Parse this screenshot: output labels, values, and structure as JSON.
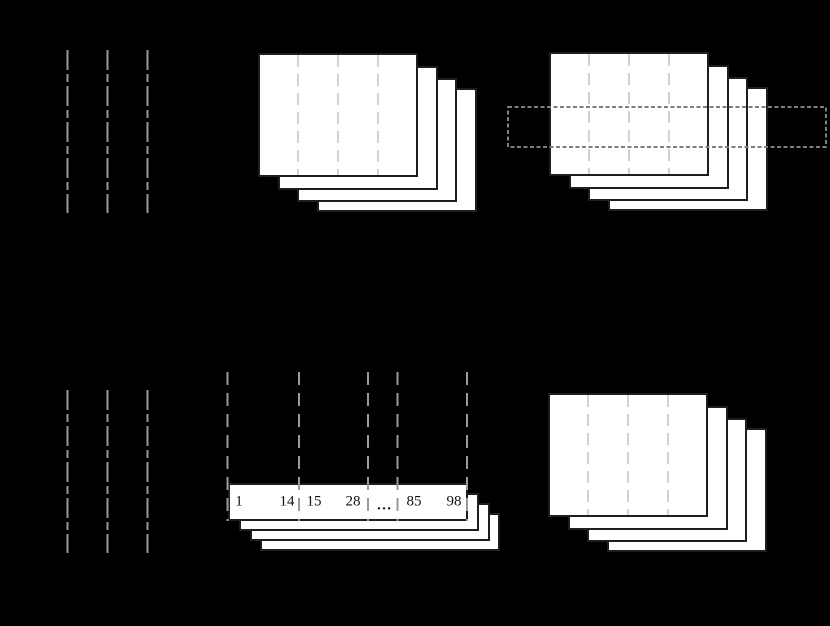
{
  "figure": {
    "background": "#000000",
    "colors": {
      "frame_fill": "#ffffff",
      "frame_border": "#1e1e1e",
      "guide_line": "#9a9a9a",
      "frame_divider": "#d2d2d2",
      "sampling_line": "#9a9a9a",
      "band_outline": "#7e7e7e",
      "index_text": "#111111"
    },
    "bottom_row": {
      "index_strip": {
        "values": [
          "1",
          "14",
          "15",
          "28",
          "…",
          "85",
          "98"
        ]
      }
    }
  }
}
